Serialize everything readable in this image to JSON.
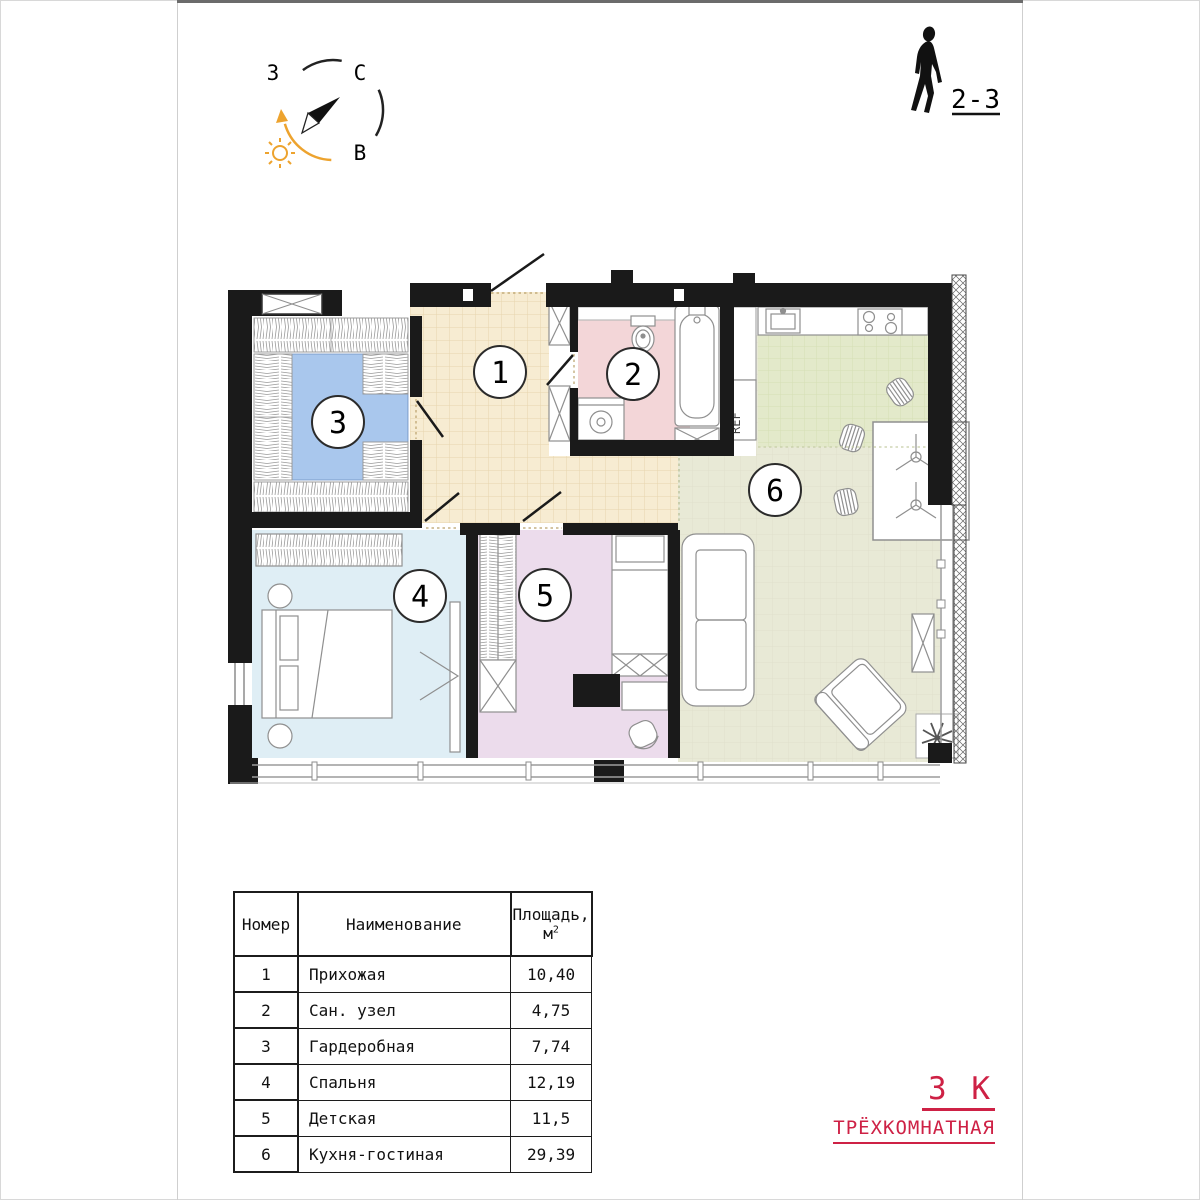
{
  "header": {
    "floors_label": "2-3"
  },
  "compass": {
    "west_label": "З",
    "north_label": "С",
    "east_label": "В"
  },
  "plan": {
    "ref_label": "REF",
    "kitchen_tile_color": "#e3e9ca",
    "wall_color": "#1a1a1a"
  },
  "rooms": [
    {
      "number": "1",
      "name": "Прихожая",
      "area": "10,40",
      "floor_color": "#f7ecd2"
    },
    {
      "number": "2",
      "name": "Сан. узел",
      "area": "4,75",
      "floor_color": "#f3d6d8"
    },
    {
      "number": "3",
      "name": "Гардеробная",
      "area": "7,74",
      "floor_color": "#a9c7ed"
    },
    {
      "number": "4",
      "name": "Спальня",
      "area": "12,19",
      "floor_color": "#dfeef5"
    },
    {
      "number": "5",
      "name": "Детская",
      "area": "11,5",
      "floor_color": "#ecdcec"
    },
    {
      "number": "6",
      "name": "Кухня-гостиная",
      "area": "29,39",
      "floor_color": "#e8e9d6"
    }
  ],
  "table": {
    "col_number": "Номер",
    "col_name": "Наименование",
    "col_area_line1": "Площадь,",
    "col_area_unit": "м",
    "col_area_sup": "2"
  },
  "apartment": {
    "type_code": "3 К",
    "type_name": "ТРЁХКОМНАТНАЯ",
    "accent_color": "#ce2145"
  }
}
